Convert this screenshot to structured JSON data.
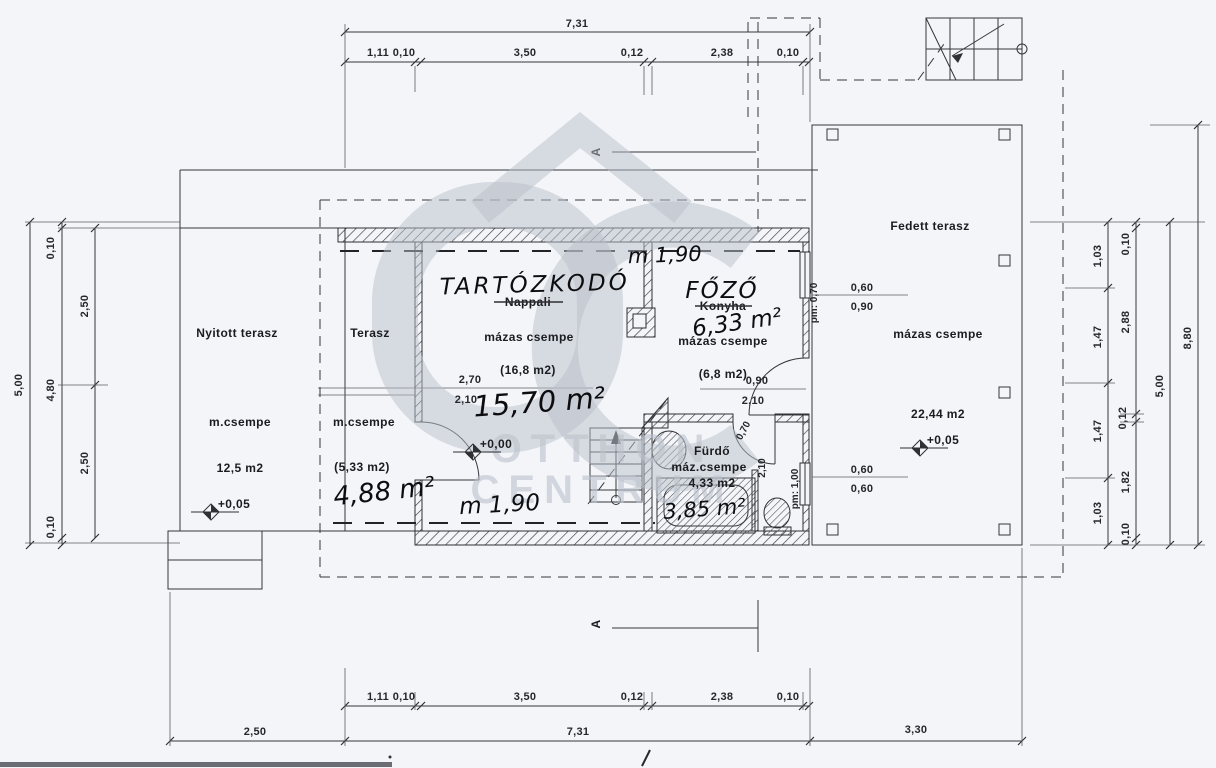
{
  "watermark": {
    "logo": "OC",
    "line1": "OTTHON",
    "line2": "CENTRUM"
  },
  "section": {
    "label": "A"
  },
  "rooms": {
    "nyitott_terasz": {
      "name": "Nyitott terasz",
      "finish": "m.csempe",
      "area": "12,5 m2",
      "level": "+0,05"
    },
    "terasz": {
      "name": "Terasz",
      "finish": "m.csempe",
      "area": "(5,33 m2)",
      "area_hand": "4,88 m²"
    },
    "tartozkodo": {
      "name_hand": "TARTÓZKODÓ",
      "name_old": "Nappali",
      "finish": "mázas csempe",
      "area": "(16,8 m2)",
      "area_hand": "15,70 m²",
      "level": "+0,00",
      "height_hand": "m 1,90"
    },
    "fozo": {
      "name_hand": "FŐZŐ",
      "name_old": "Konyha",
      "finish": "mázas csempe",
      "area": "(6,8 m2)",
      "area_hand": "6,33 m²",
      "height_hand": "m 1,90"
    },
    "furdo": {
      "name": "Fürdő",
      "finish": "máz.csempe",
      "area": "4,33 m2",
      "area_hand": "3,85 m²"
    },
    "fedett_terasz": {
      "name": "Fedett terasz",
      "finish": "mázas csempe",
      "area": "22,44 m2",
      "level": "+0,05"
    }
  },
  "dims": {
    "top_total": "7,31",
    "top_segments": [
      "1,11",
      "0,10",
      "3,50",
      "0,12",
      "2,38",
      "0,10"
    ],
    "bottom_segments": [
      "1,11",
      "0,10",
      "3,50",
      "0,12",
      "2,38",
      "0,10"
    ],
    "bottom_totals": [
      "2,50",
      "7,31",
      "3,30"
    ],
    "left_total": "5,00",
    "left_chain": [
      "0,10",
      "4,80",
      "0,10"
    ],
    "left_inner": [
      "2,50",
      "2,50"
    ],
    "right_inner": [
      "1,03",
      "1,47",
      "1,47",
      "1,03"
    ],
    "right_chain": [
      "0,10",
      "2,88",
      "0,12",
      "1,82",
      "0,10"
    ],
    "right_total": "5,00",
    "right_overall": "8,80"
  },
  "openings": {
    "living_glass_w": "2,70",
    "living_glass_h": "2,10",
    "kitchen_door_w": "0,90",
    "kitchen_door_h": "2,10",
    "kitchen_window_parapet": "pm: 0,70",
    "bath_door_w": "0,70",
    "bath_door_h": "2,10",
    "bath_window_parapet": "pm: 1,00",
    "window1_w": "0,60",
    "window1_h": "0,90",
    "window2_w": "0,60",
    "window2_h": "0,60"
  }
}
